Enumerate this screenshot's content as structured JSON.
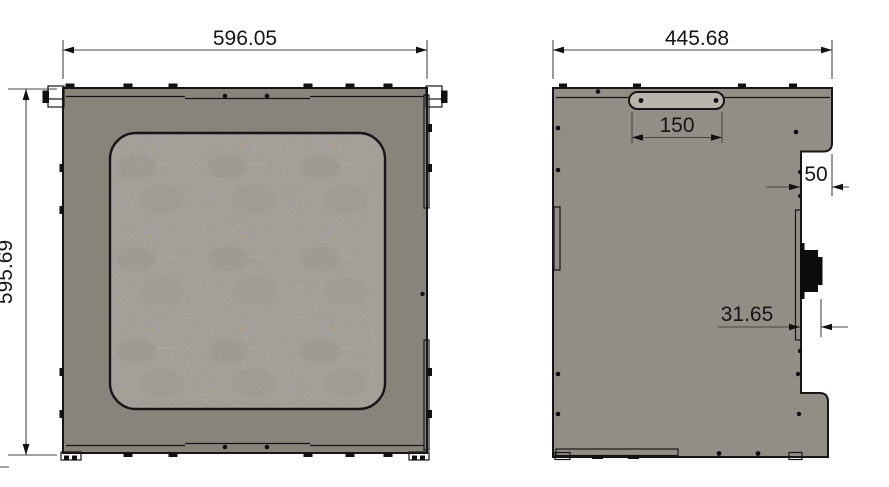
{
  "drawing_title": "enclosure-panel-two-view-technical-drawing",
  "colors": {
    "background": "#ffffff",
    "outline": "#161616",
    "front_panel": "#86847b",
    "window_base": "#9f9b93",
    "side_panel": "#918e86",
    "slot_fill": "#b7b5ac",
    "connector": "#0d0d0d"
  },
  "front_view": {
    "width_dim": "596.05",
    "height_dim": "595.69"
  },
  "side_view": {
    "width_dim": "445.68",
    "slot_dim": "150",
    "notch_dim": "50",
    "connector_dim": "31.65"
  }
}
